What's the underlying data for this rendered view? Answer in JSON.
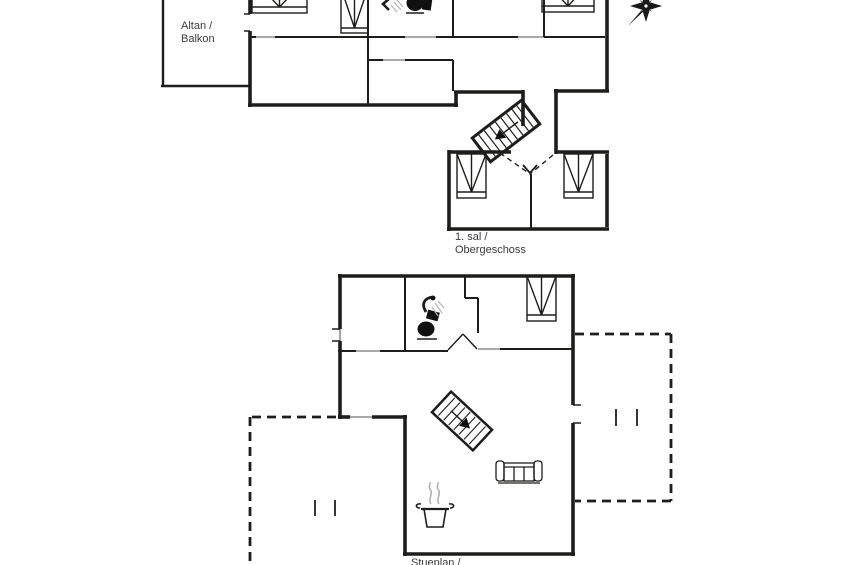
{
  "colors": {
    "background": "#ffffff",
    "line": "#1d1d1b",
    "steam": "#b5b5b5",
    "text": "#3a3a3a"
  },
  "labels": {
    "balcony_line1": "Altan /",
    "balcony_line2": "Balkon",
    "upper_floor_line1": "1. sal /",
    "upper_floor_line2": "Obergeschoss",
    "lower_floor_line1": "Stueplan /"
  },
  "icons": {
    "compass": "compass-rose-icon",
    "staircase": "staircase-icon",
    "toilet": "toilet-icon",
    "shower": "shower-icon",
    "bed": "bed-icon",
    "sofa": "sofa-icon",
    "cooking_pot": "cooking-pot-icon",
    "steam": "steam-icon",
    "window_marks": "window-mark-icon",
    "door_swing": "door-swing-dashes"
  }
}
